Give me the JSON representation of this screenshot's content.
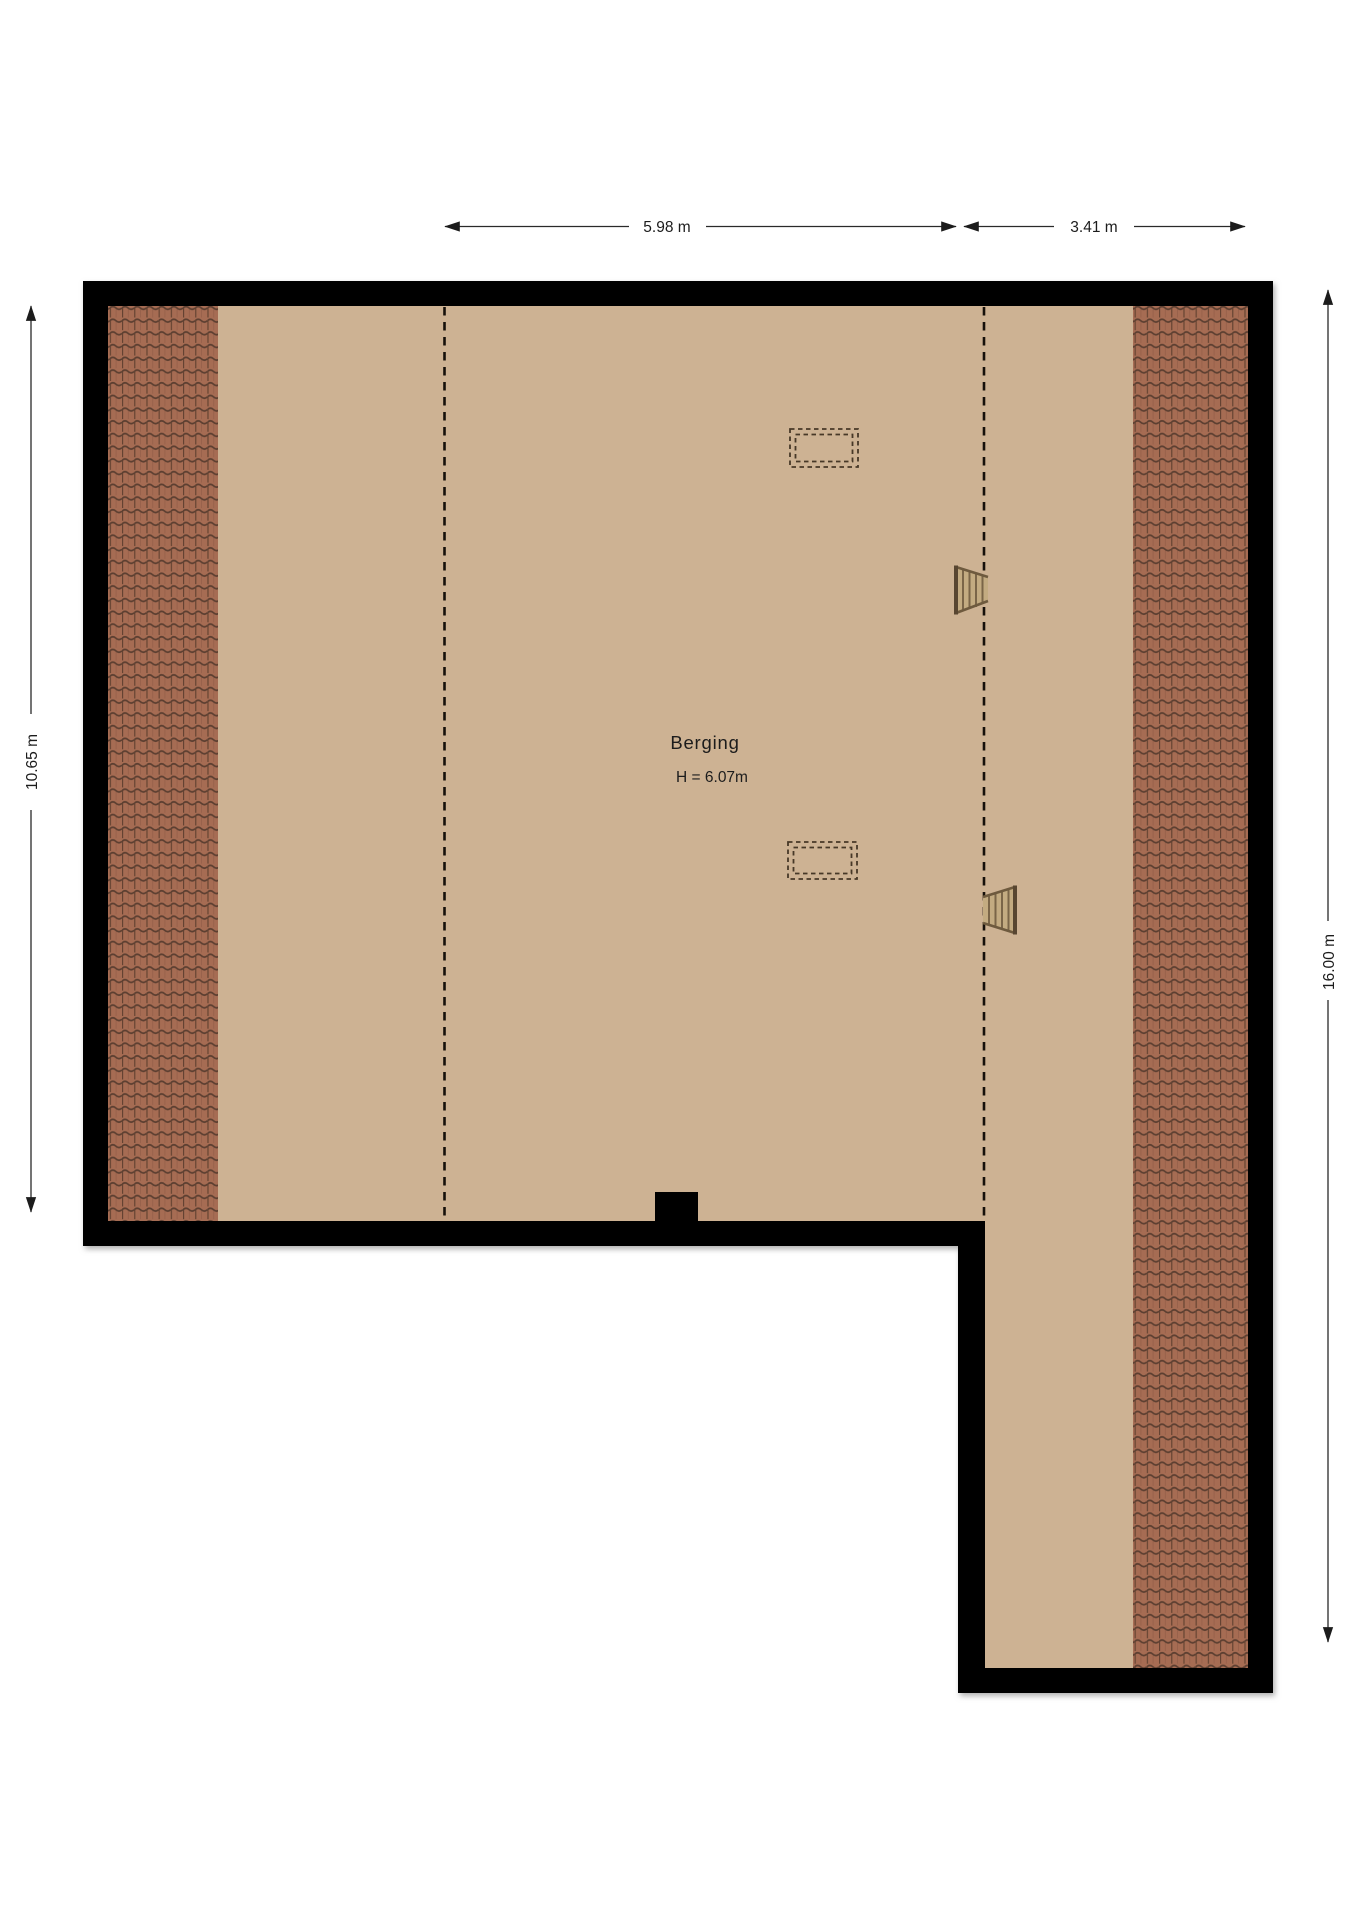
{
  "plan": {
    "room": {
      "label": "Berging",
      "height_label": "H = 6.07m"
    },
    "dimensions": {
      "top_first": "5.98 m",
      "top_second": "3.41 m",
      "left": "10.65 m",
      "right": "16.00 m"
    },
    "colors": {
      "wall": "#000000",
      "floor": "#cdb293",
      "roof_tile": "#a66c53",
      "roof_tile_line": "#5c3f31",
      "dimension_text": "#1c1c1c",
      "stair_rail": "#6e5a3e"
    },
    "icons": {
      "upper_stairs": "ladder-icon",
      "lower_stairs": "ladder-icon",
      "upper_skylight": "skylight-dashed-rect",
      "lower_skylight": "skylight-dashed-rect"
    }
  }
}
